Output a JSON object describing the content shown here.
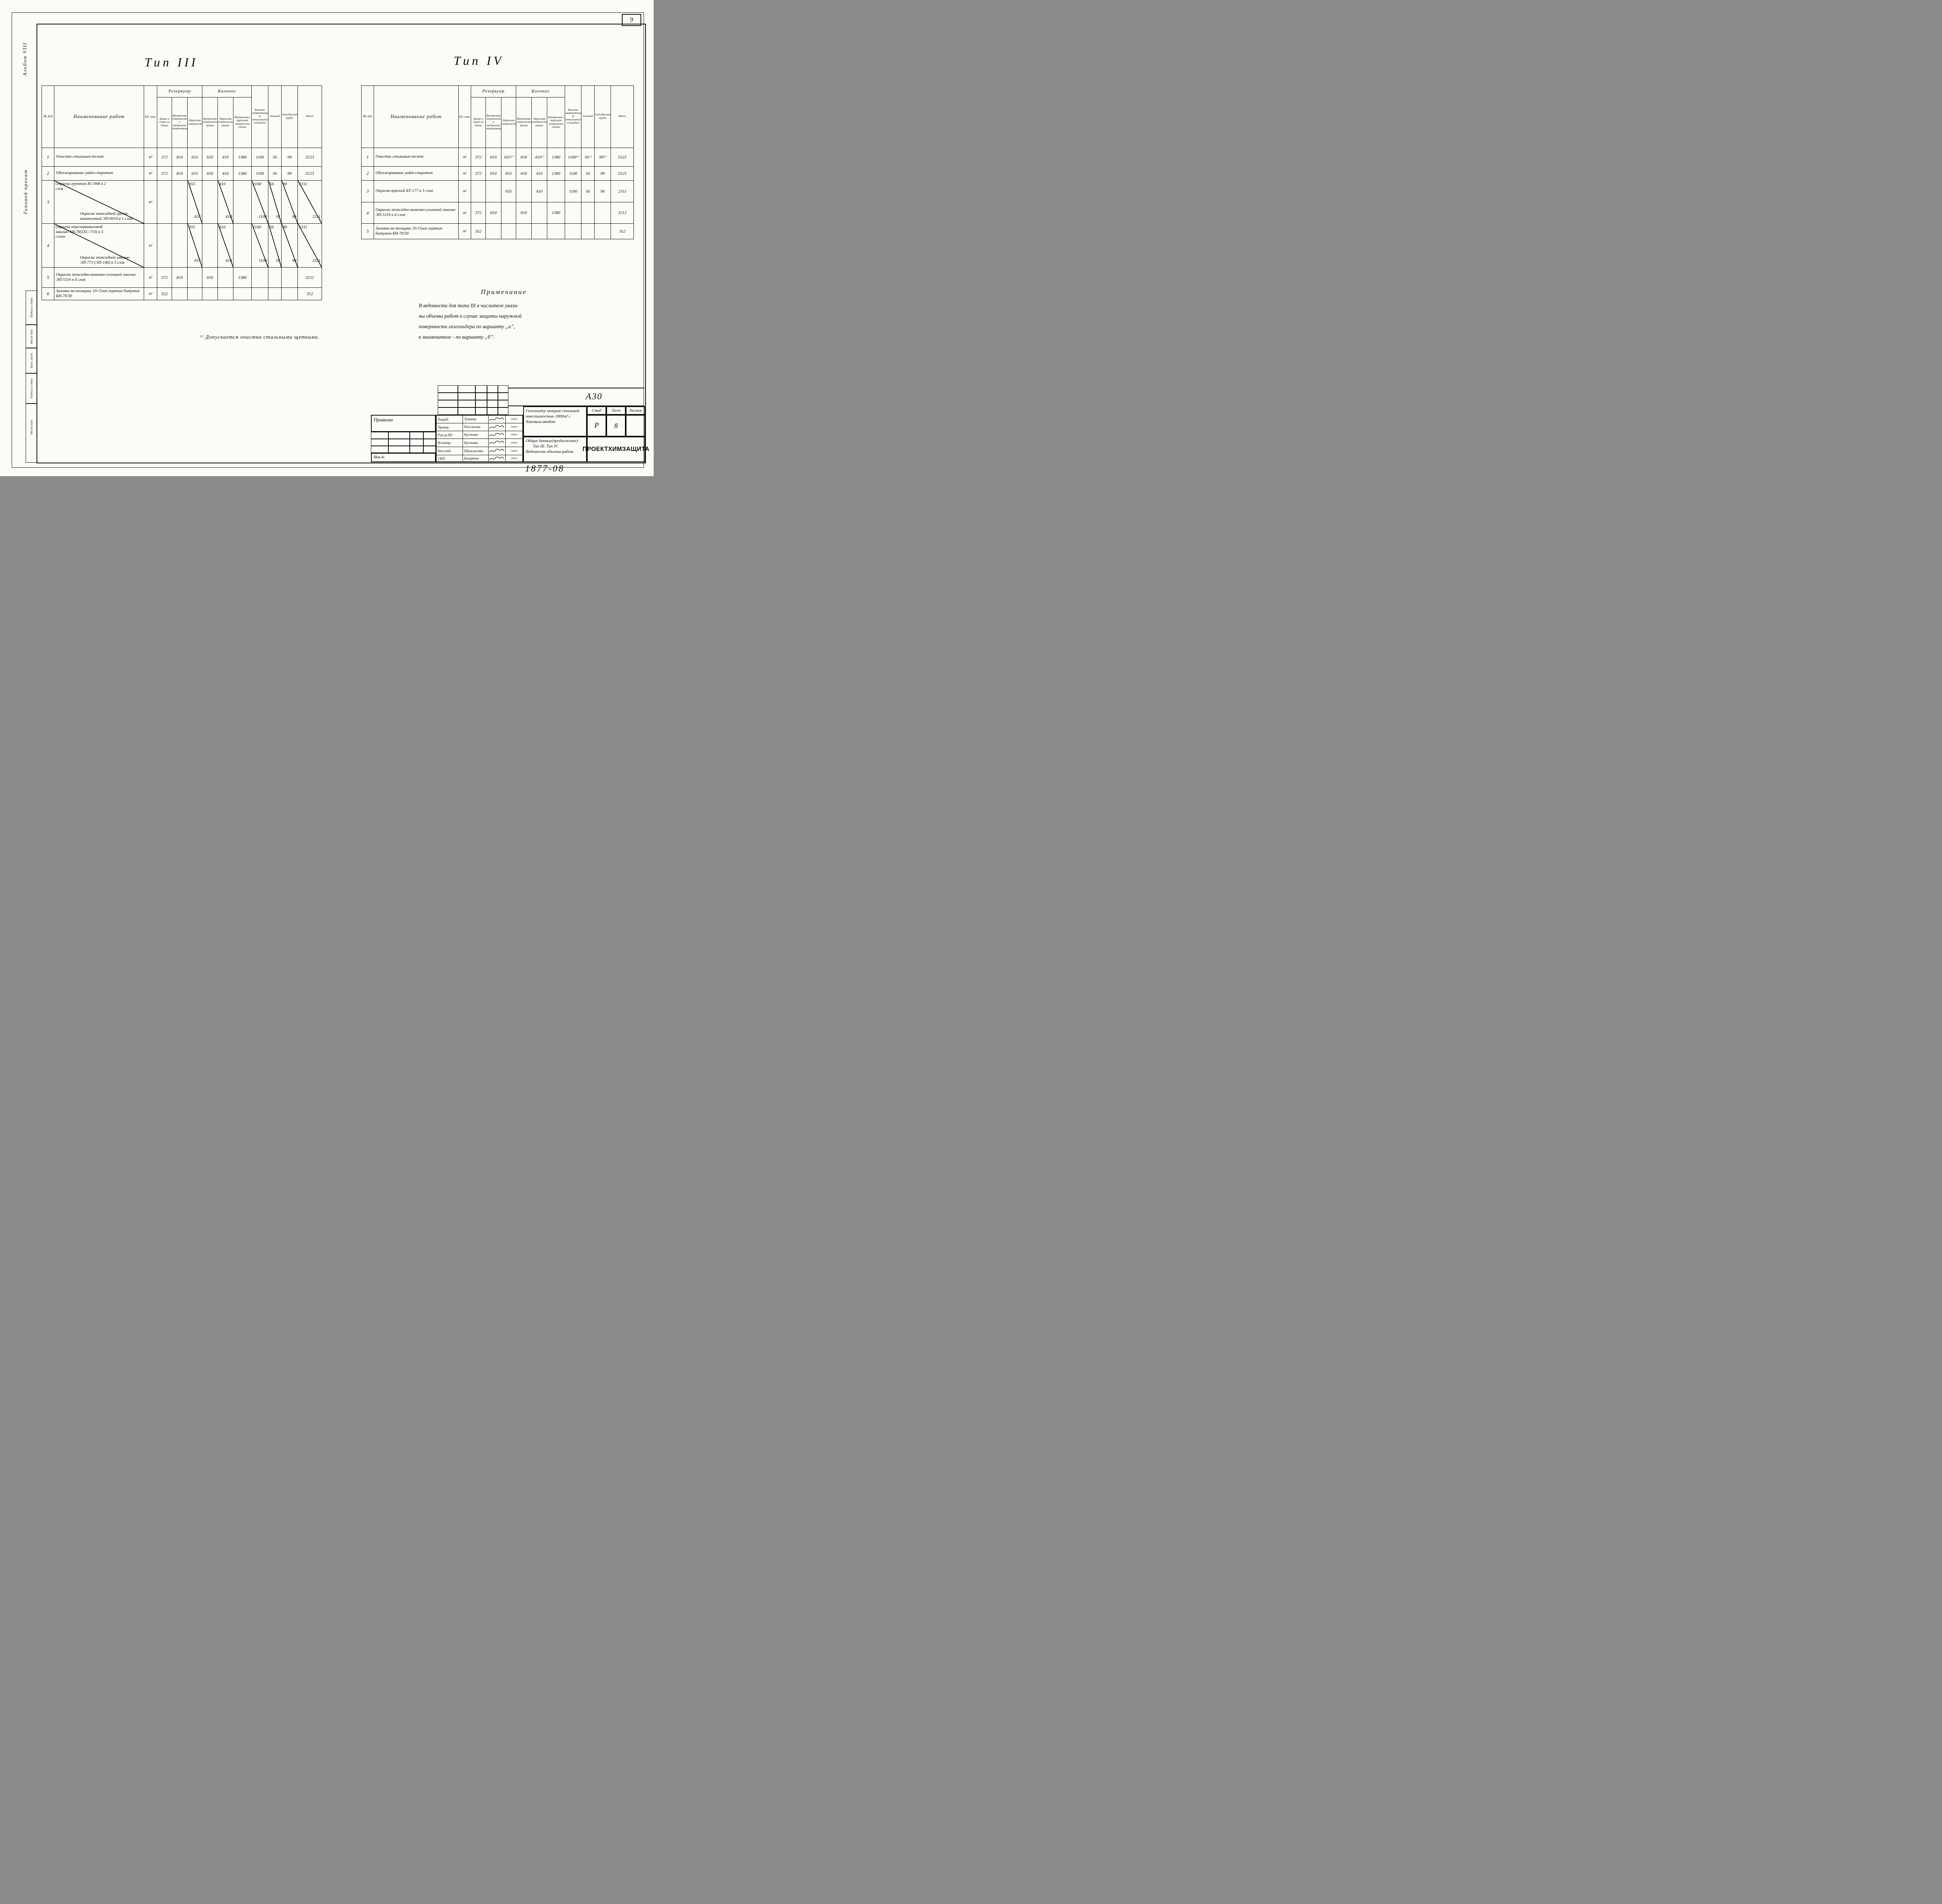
{
  "page": {
    "sheet_corner_number": "9",
    "doc_number": "1877-08",
    "album_label": "Альбом VIII",
    "project_label": "Типовой проект",
    "margin_labels": [
      "Подписи и дата",
      "Инв.№ дубл.",
      "Взам. инв.№",
      "Подписи и дата",
      "Инв.№ подл."
    ]
  },
  "header": {
    "num": "№ п/п",
    "name": "Наименование работ",
    "unit": "Ед. изм.",
    "groups": [
      {
        "label": "Резервуар"
      },
      {
        "label": "Колокол"
      }
    ]
  },
  "columns": [
    "Днище и опоры на днище",
    "Внутренняя поверхность и внутренние направляющие",
    "Наружная поверхность",
    "Внутренняя поверхность крыши",
    "Наружная поверхность крыши",
    "Внутренняя и наружная поверхность стенки",
    "Внешние направляющие (и металлоконструкции площадки)",
    "Газоввод",
    "Газосбросная труба",
    "Итого"
  ],
  "type3": {
    "title": "Тип III",
    "rows": [
      {
        "num": "1",
        "unit": "м²",
        "name": "Очистка стальным песком",
        "values": [
          "372",
          "810",
          "655",
          "650",
          "410",
          "1380",
          "1100",
          "56",
          "90",
          "5523"
        ]
      },
      {
        "num": "2",
        "unit": "м²",
        "name": "Обезжиривание уайт-спиритом",
        "values": [
          "372",
          "810",
          "655",
          "650",
          "410",
          "1380",
          "1100",
          "56",
          "90",
          "5523"
        ]
      },
      {
        "num": "3",
        "unit": "м²",
        "name": {
          "t": "Окраска грунтом ХС-068 в 2 слоя",
          "b": "Окраска эпоксидной грунт-шпатлевкой ЭП-0010 в 1 слой"
        },
        "values": [
          "",
          "",
          {
            "t": "655",
            "b": "655"
          },
          "",
          {
            "t": "410",
            "b": "410"
          },
          "",
          {
            "t": "1100",
            "b": "1100"
          },
          {
            "t": "56",
            "b": "56"
          },
          {
            "t": "90",
            "b": "90"
          },
          {
            "t": "2311",
            "b": "2311"
          }
        ]
      },
      {
        "num": "4",
        "unit": "м²",
        "name": {
          "t": "Окраска перхлорвиниловой эмалью ХВ-785(ХС-710) в 5 слоев",
          "b": "Окраска эпоксидной эмалью ЭП-773 (ЭП-140) в 3 слоя"
        },
        "values": [
          "",
          "",
          {
            "t": "655",
            "b": "655"
          },
          "",
          {
            "t": "410",
            "b": "410"
          },
          "",
          {
            "t": "1100",
            "b": "1100"
          },
          {
            "t": "56",
            "b": "56"
          },
          {
            "t": "90",
            "b": "90"
          },
          {
            "t": "2311",
            "b": "2311"
          }
        ]
      },
      {
        "num": "5",
        "unit": "м²",
        "name": "Окраска эпоксидно-каменно-угольной эмалью ЭП-5116 в 4 слоя",
        "values": [
          "372",
          "810",
          "",
          "650",
          "",
          "1380",
          "",
          "",
          "",
          "3212"
        ]
      },
      {
        "num": "6",
        "unit": "м²",
        "name": "Заливка на толщину 10-15мм горячим битумом БН-70/30",
        "values": [
          "352",
          "",
          "",
          "",
          "",
          "",
          "",
          "",
          "",
          "352"
        ]
      }
    ]
  },
  "type4": {
    "title": "Тип IV",
    "rows": [
      {
        "num": "1",
        "unit": "м²",
        "name": "Очистка стальным песком",
        "values": [
          "372",
          "810",
          "655¹⁾",
          "650",
          "410¹⁾",
          "1380",
          "1100¹⁾",
          "56¹⁾",
          "90¹⁾",
          "5523"
        ]
      },
      {
        "num": "2",
        "unit": "м²",
        "name": "Обезжиривание уайт-спиритом",
        "values": [
          "372",
          "810",
          "655",
          "650",
          "410",
          "1380",
          "1100",
          "56",
          "90",
          "5523"
        ]
      },
      {
        "num": "3",
        "unit": "м²",
        "name": "Окраска краской БТ-177 в 3 слоя",
        "values": [
          "",
          "",
          "655",
          "",
          "410",
          "",
          "1100",
          "56",
          "90",
          "2311"
        ]
      },
      {
        "num": "4",
        "unit": "м²",
        "name": "Окраска эпоксидно-каменно-угольной эмалью ЭП-5116 в 4 слоя",
        "values": [
          "372",
          "810",
          "",
          "650",
          "",
          "1380",
          "",
          "",
          "",
          "3212"
        ]
      },
      {
        "num": "5",
        "unit": "м²",
        "name": "Заливка на толщину 10-15мм горячим битумом БН-70/30",
        "values": [
          "352",
          "",
          "",
          "",
          "",
          "",
          "",
          "",
          "",
          "352"
        ]
      }
    ]
  },
  "note": {
    "title": "Примечание",
    "lines": [
      "В ведомости для типа III в числителе указа-",
      "ны объемы работ в случае защиты наружной",
      "поверхности газгольдера по варианту „а”,",
      "в знаменателе - по варианту „б”."
    ]
  },
  "footnote": "¹⁾ Допускается очистка стальными щетками.",
  "stamp": {
    "code": "А30",
    "attach": "Привязан",
    "inv": "Инв.№",
    "sig_rows": [
      {
        "role": "Разраб.",
        "name": "Туваева",
        "date": "30595"
      },
      {
        "role": "Провер.",
        "name": "Рогожина",
        "date": "30595"
      },
      {
        "role": "Рук.гр.ХО",
        "name": "Кустова",
        "date": "30595"
      },
      {
        "role": "Н.контр.",
        "name": "Кустова",
        "date": "30595"
      },
      {
        "role": "Нач.отд.",
        "name": "Шульженко",
        "date": "30595"
      },
      {
        "role": "ГИП",
        "name": "Бачурина",
        "date": "30595"
      }
    ],
    "project_title": "Газгольдер мокрый стальной вместимостью 3000м³ с боковым вводом",
    "sheet_title_lines": [
      "Общие данные(продолжение)",
      "Тип III.   Тип IV.",
      "Ведомости объемов работ."
    ],
    "stage_label": "Стад",
    "sheet_label": "Лист",
    "sheets_label": "Листов",
    "stage": "Р",
    "sheet": "8",
    "sheets": "",
    "org": "ПРОЕКТХИМЗАЩИТА"
  }
}
